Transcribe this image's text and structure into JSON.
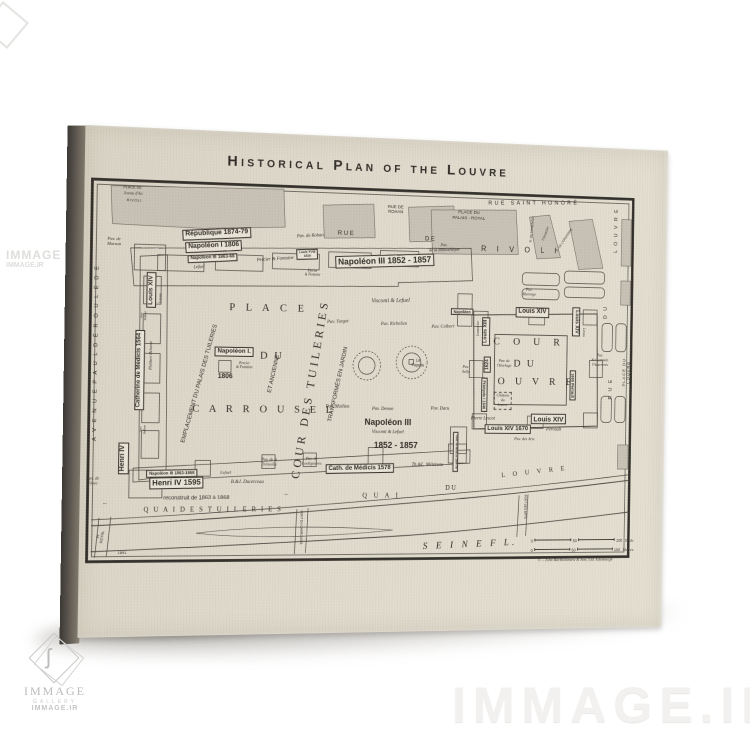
{
  "colors": {
    "paper": "#ded9ca",
    "ink": "#2f2b25",
    "block_shade": "#c6c1b4",
    "canvas_side": "#55504a",
    "watermark": "#f2f1ef"
  },
  "watermark": {
    "site": "IMMAGE.IR",
    "logo_text": "IMMAGE",
    "logo_sub": "GALLERY",
    "logo_site": "IMMAGE.IR",
    "side_text": "IMMAGE",
    "side_site": "IMMAGE.IR"
  },
  "map": {
    "title": "Historical Plan of the Louvre",
    "copyright": "© – John Bartholomew & Son, Ltd. Edinburgh",
    "scale": {
      "yards": {
        "ticks": [
          "0",
          "50",
          "100"
        ],
        "unit": "Yards"
      },
      "metres": {
        "ticks": [
          "0",
          "50",
          "100"
        ],
        "unit": "Metres"
      }
    },
    "labels": [
      {
        "t": "R U E",
        "x": 274,
        "y": 101,
        "s": 6.5,
        "c": "g"
      },
      {
        "t": "D E",
        "x": 366,
        "y": 104,
        "s": 6.5,
        "c": "g"
      },
      {
        "t": "R I V O L I",
        "x": 468,
        "y": 112,
        "s": 8,
        "c": "g",
        "ls": 0.6
      },
      {
        "t": "RUE DE\nROHAN",
        "x": 328,
        "y": 74,
        "s": 4.6,
        "c": "g"
      },
      {
        "t": "PLACE DU\nPALAIS - ROYAL",
        "x": 409,
        "y": 78,
        "s": 4.8,
        "c": "g"
      },
      {
        "t": "RUE  SAINT  HONORÉ",
        "x": 482,
        "y": 63,
        "s": 6,
        "c": "g",
        "ls": 0.45,
        "r": -2
      },
      {
        "t": "Pav. de Rohan",
        "x": 236,
        "y": 105,
        "s": 5,
        "c": "i",
        "r": -4
      },
      {
        "t": "Pav.\nde la Bibliothèque",
        "x": 382,
        "y": 112,
        "s": 4.6,
        "c": "i",
        "r": -3
      },
      {
        "t": "R. DE MARENGO",
        "x": 480,
        "y": 90,
        "s": 3.4,
        "c": "g",
        "r": -85
      },
      {
        "t": "l'Oratoire",
        "x": 496,
        "y": 94,
        "s": 4,
        "c": "i",
        "r": -70
      },
      {
        "t": "R. DE L'ORATOIRE",
        "x": 517,
        "y": 100,
        "s": 3.4,
        "c": "g",
        "r": -55
      },
      {
        "t": "L O U V R E",
        "x": 577,
        "y": 88,
        "s": 5.5,
        "c": "g",
        "r": -90,
        "ls": 0.3
      },
      {
        "t": "D U",
        "x": 566,
        "y": 176,
        "s": 5.5,
        "c": "g",
        "r": -90,
        "ls": 0.3
      },
      {
        "t": "R U E",
        "x": 573,
        "y": 258,
        "s": 5.5,
        "c": "g",
        "r": -90,
        "ls": 0.3
      },
      {
        "t": "PLACE  DU  LOUVRE",
        "x": 591,
        "y": 240,
        "s": 4.6,
        "c": "g",
        "r": -90,
        "ls": 0.2
      },
      {
        "t": "PLACE DE",
        "x": 49,
        "y": 61,
        "s": 3.8,
        "c": "g"
      },
      {
        "t": "Jeanne d'Arc",
        "x": 50,
        "y": 67,
        "s": 3.8,
        "c": "i"
      },
      {
        "t": "RIVOLI",
        "x": 51,
        "y": 74,
        "s": 3.8,
        "c": "g",
        "ls": 0.15
      },
      {
        "t": "Pav. de\nMarsan",
        "x": 31,
        "y": 116,
        "s": 4.6,
        "c": "i"
      },
      {
        "t": "République 1874-79",
        "x": 137,
        "y": 105,
        "s": 7,
        "c": "gb bx",
        "r": -4
      },
      {
        "t": "Napoléon I 1806",
        "x": 134,
        "y": 118,
        "s": 7,
        "c": "gb bx",
        "r": -4
      },
      {
        "t": "Napoléon III 1863-68",
        "x": 133,
        "y": 130,
        "s": 4.8,
        "c": "gb bx",
        "r": -4
      },
      {
        "t": "Lefuel",
        "x": 119,
        "y": 139,
        "s": 4.6,
        "c": "i",
        "r": -4
      },
      {
        "t": "Percier & Fontaine",
        "x": 199,
        "y": 130,
        "s": 5,
        "c": "i",
        "r": -5
      },
      {
        "t": "Louis XVIII\n1816",
        "x": 233,
        "y": 123,
        "s": 3.4,
        "c": "gb bx",
        "r": -3
      },
      {
        "t": "Percier\n& Fontaine",
        "x": 239,
        "y": 142,
        "s": 3.6,
        "c": "i"
      },
      {
        "t": "Napoléon III  1852 - 1857",
        "x": 317,
        "y": 128,
        "s": 9,
        "c": "gb bx",
        "r": -3
      },
      {
        "t": "Louis XIV",
        "x": 70,
        "y": 164,
        "s": 6.5,
        "c": "gb bx",
        "r": -90
      },
      {
        "t": "Levau",
        "x": 80,
        "y": 172,
        "s": 4,
        "c": "i",
        "r": -90
      },
      {
        "t": "A V E N U E   P A U L   D É R O U L È D E",
        "x": 15,
        "y": 228,
        "s": 5.8,
        "c": "g",
        "r": -90,
        "ls": 0.35
      },
      {
        "t": "Catherine de Médicis 1564",
        "x": 59,
        "y": 245,
        "s": 6,
        "c": "gb bx",
        "r": -90
      },
      {
        "t": "Philibert Delorme",
        "x": 71,
        "y": 230,
        "s": 4,
        "c": "i",
        "r": -90
      },
      {
        "t": "Jean\nBullant",
        "x": 63,
        "y": 190,
        "s": 3.2,
        "c": "i",
        "r": -90
      },
      {
        "t": "Jean\nBullant",
        "x": 64,
        "y": 305,
        "s": 3.2,
        "c": "i",
        "r": -90
      },
      {
        "t": "EMPLACEMENT  DU  PALAIS  DES  TUILERIES",
        "x": 122,
        "y": 258,
        "s": 6,
        "c": "g",
        "r": -75
      },
      {
        "t": "ET  ANCIENNE",
        "x": 200,
        "y": 247,
        "s": 6,
        "c": "g",
        "r": -78
      },
      {
        "t": "COUR DES TUILERIES",
        "x": 238,
        "y": 262,
        "s": 12,
        "c": "sp",
        "r": -81,
        "ls": 0.3
      },
      {
        "t": "TRANSFORMÉS  EN  JARDIN",
        "x": 269,
        "y": 257,
        "s": 6,
        "c": "g",
        "r": -78
      },
      {
        "t": "P L A C E",
        "x": 193,
        "y": 180,
        "s": 11,
        "c": "sp",
        "ls": 0.4
      },
      {
        "t": "D U",
        "x": 197,
        "y": 229,
        "s": 11,
        "c": "sp",
        "ls": 0.2
      },
      {
        "t": "C A R R O U S E L",
        "x": 190,
        "y": 284,
        "s": 11,
        "c": "sp",
        "ls": 0.35
      },
      {
        "t": "Napoléon I.",
        "x": 157,
        "y": 225,
        "s": 6.5,
        "c": "gb bx"
      },
      {
        "t": "Percier\n& Fontaine",
        "x": 168,
        "y": 239,
        "s": 3.8,
        "c": "i"
      },
      {
        "t": "1806",
        "x": 148,
        "y": 251,
        "s": 7,
        "c": "gb"
      },
      {
        "t": "Pav. Turgot",
        "x": 267,
        "y": 193,
        "s": 5,
        "c": "i",
        "r": -3
      },
      {
        "t": "Visconti  &  Lefuel",
        "x": 324,
        "y": 170,
        "s": 6,
        "c": "i",
        "r": -2
      },
      {
        "t": "Pav. Richelieu",
        "x": 328,
        "y": 194,
        "s": 5,
        "c": "i",
        "r": -2
      },
      {
        "t": "Pav. Colbert",
        "x": 382,
        "y": 196,
        "s": 5,
        "c": "i",
        "r": -2
      },
      {
        "t": "Napoléon",
        "x": 403,
        "y": 179,
        "s": 4.2,
        "c": "gb bx"
      },
      {
        "t": "Pav.\nMarengo",
        "x": 478,
        "y": 157,
        "s": 4.2,
        "c": "i"
      },
      {
        "t": "Louis XIV",
        "x": 482,
        "y": 178,
        "s": 7,
        "c": "gb bx"
      },
      {
        "t": "Louis XIII",
        "x": 430,
        "y": 199,
        "s": 5.5,
        "c": "gb bx",
        "r": -90
      },
      {
        "t": "Lemercier",
        "x": 421,
        "y": 196,
        "s": 3.8,
        "c": "i",
        "r": -90
      },
      {
        "t": "1624",
        "x": 432,
        "y": 234,
        "s": 5,
        "c": "gb bx",
        "r": -90
      },
      {
        "t": "Pav.\nSully",
        "x": 408,
        "y": 240,
        "s": 4.2,
        "c": "i"
      },
      {
        "t": "Pav. de\nl'Horloge",
        "x": 451,
        "y": 233,
        "s": 4.2,
        "c": "i"
      },
      {
        "t": "C O U R",
        "x": 479,
        "y": 210,
        "s": 11,
        "c": "sp",
        "ls": 0.55
      },
      {
        "t": "D U",
        "x": 474,
        "y": 233,
        "s": 11,
        "c": "sp",
        "ls": 0.2
      },
      {
        "t": "L O U V R E",
        "x": 479,
        "y": 252,
        "s": 11,
        "c": "sp",
        "ls": 0.4
      },
      {
        "t": "François I  1546",
        "x": 429,
        "y": 266,
        "s": 4.2,
        "c": "gb bx",
        "r": 90
      },
      {
        "t": "Château\ndu\nLouvre",
        "x": 450,
        "y": 272,
        "s": 4.2,
        "c": "i dbx"
      },
      {
        "t": "Pierre Lescot",
        "x": 428,
        "y": 292,
        "s": 5,
        "c": "i"
      },
      {
        "t": "Louis XIV",
        "x": 502,
        "y": 291,
        "s": 7.5,
        "c": "gb bx"
      },
      {
        "t": "Louis XIV   1670",
        "x": 456,
        "y": 302,
        "s": 6.5,
        "c": "gb bx"
      },
      {
        "t": "Perrault",
        "x": 508,
        "y": 303,
        "s": 5,
        "c": "i"
      },
      {
        "t": "Pav. des Arts",
        "x": 475,
        "y": 312,
        "s": 4.4,
        "c": "i"
      },
      {
        "t": "Louis XIV",
        "x": 532,
        "y": 187,
        "s": 5.5,
        "c": "gb bx",
        "r": 90
      },
      {
        "t": "Levau",
        "x": 541,
        "y": 198,
        "s": 3.8,
        "c": "i",
        "r": 90
      },
      {
        "t": "1665  Perrault",
        "x": 529,
        "y": 255,
        "s": 4.2,
        "c": "gb bx",
        "r": 90
      },
      {
        "t": "Pav.\nSt Germain\nl'Auxerrois",
        "x": 560,
        "y": 228,
        "s": 4.2,
        "c": "i"
      },
      {
        "t": "La\nFayette",
        "x": 355,
        "y": 234,
        "s": 4.2,
        "c": "g"
      },
      {
        "t": "Pav. Mollien",
        "x": 268,
        "y": 281,
        "s": 5,
        "c": "i"
      },
      {
        "t": "Pav. Denon",
        "x": 317,
        "y": 283,
        "s": 5,
        "c": "i"
      },
      {
        "t": "Pav. Daru",
        "x": 380,
        "y": 282,
        "s": 5,
        "c": "i"
      },
      {
        "t": "Napoléon III",
        "x": 323,
        "y": 296,
        "s": 9,
        "c": "gb"
      },
      {
        "t": "Visconti & Lefuel",
        "x": 323,
        "y": 307,
        "s": 5,
        "c": "i"
      },
      {
        "t": "1852   -   1857",
        "x": 332,
        "y": 320,
        "s": 9,
        "c": "gb"
      },
      {
        "t": "Cath. de Médicis 1578",
        "x": 293,
        "y": 344,
        "s": 6.5,
        "c": "gb bx",
        "r": -1
      },
      {
        "t": "Th.&L. Métézeau",
        "x": 367,
        "y": 341,
        "s": 5,
        "c": "i"
      },
      {
        "t": "Cath. de Médicis 1564-78",
        "x": 398,
        "y": 326,
        "s": 3,
        "c": "gb bx",
        "r": 90
      },
      {
        "t": "Henri IV",
        "x": 44,
        "y": 334,
        "s": 7,
        "c": "gb bx",
        "r": -90
      },
      {
        "t": "Pav. de\nFlore",
        "x": 13,
        "y": 357,
        "s": 4.6,
        "c": "i"
      },
      {
        "t": "Napoléon III 1863-1868",
        "x": 94,
        "y": 349,
        "s": 4.4,
        "c": "gb bx",
        "r": -1
      },
      {
        "t": "Lefuel",
        "x": 150,
        "y": 348,
        "s": 4.6,
        "c": "i"
      },
      {
        "t": "Henri IV   1595",
        "x": 99,
        "y": 359,
        "s": 8,
        "c": "gb bx",
        "r": -1
      },
      {
        "t": "B.&J. Ducerceau",
        "x": 173,
        "y": 359,
        "s": 5,
        "c": "i"
      },
      {
        "t": "Pav. de la\nTrémoille",
        "x": 196,
        "y": 338,
        "s": 4.2,
        "c": "i"
      },
      {
        "t": "Pav. de\nLesdiguières",
        "x": 241,
        "y": 337,
        "s": 4.2,
        "c": "i"
      },
      {
        "t": "←",
        "x": 26,
        "y": 380,
        "s": 6,
        "c": "g"
      },
      {
        "t": "reconstruit    de    1863    à    1868",
        "x": 120,
        "y": 375,
        "s": 5.8,
        "c": "g"
      },
      {
        "t": "→",
        "x": 214,
        "y": 371,
        "s": 6,
        "c": "g"
      },
      {
        "t": "Q U A I    D E S    T U I L E R I E S",
        "x": 138,
        "y": 386,
        "s": 7,
        "c": "sp",
        "ls": 0.25
      },
      {
        "t": "PONT DU CARROUSEL",
        "x": 230,
        "y": 405,
        "s": 3.2,
        "c": "g",
        "r": 90
      },
      {
        "t": "Q U A I",
        "x": 317,
        "y": 372,
        "s": 7,
        "c": "sp",
        "ls": 0.4
      },
      {
        "t": "D U",
        "x": 393,
        "y": 364,
        "s": 7,
        "c": "sp"
      },
      {
        "t": "L O U V R E",
        "x": 487,
        "y": 347,
        "s": 7,
        "c": "sp",
        "ls": 0.5,
        "r": -6
      },
      {
        "t": "PONT DES ARTS",
        "x": 476,
        "y": 384,
        "s": 3.2,
        "c": "g",
        "r": 90
      },
      {
        "t": "S E I N E     F L.",
        "x": 416,
        "y": 424,
        "s": 10,
        "c": "i",
        "ls": 0.35,
        "r": -2
      },
      {
        "t": "Pt\nROYAL",
        "x": 22,
        "y": 413,
        "s": 3.8,
        "c": "g",
        "r": -82
      },
      {
        "t": "1891",
        "x": 44,
        "y": 430,
        "s": 4,
        "c": "g"
      }
    ]
  }
}
